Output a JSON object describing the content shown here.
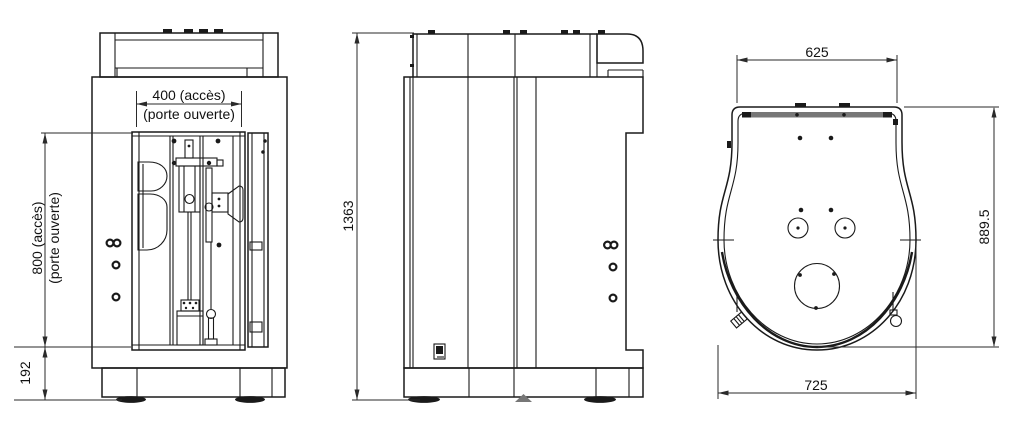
{
  "dimensions": {
    "front": {
      "width_access": "400 (accès)",
      "width_access_note": "(porte ouverte)",
      "height_access": "800 (accès)",
      "height_access_note": "(porte ouverte)",
      "base_height": "192"
    },
    "side": {
      "overall_height": "1363"
    },
    "top": {
      "width_top": "625",
      "depth": "889.5",
      "width_overall": "725"
    }
  },
  "colors": {
    "background": "#ffffff",
    "lines": "#1a1a1a",
    "dimension_lines": "#2a2a2a",
    "text": "#111111"
  }
}
